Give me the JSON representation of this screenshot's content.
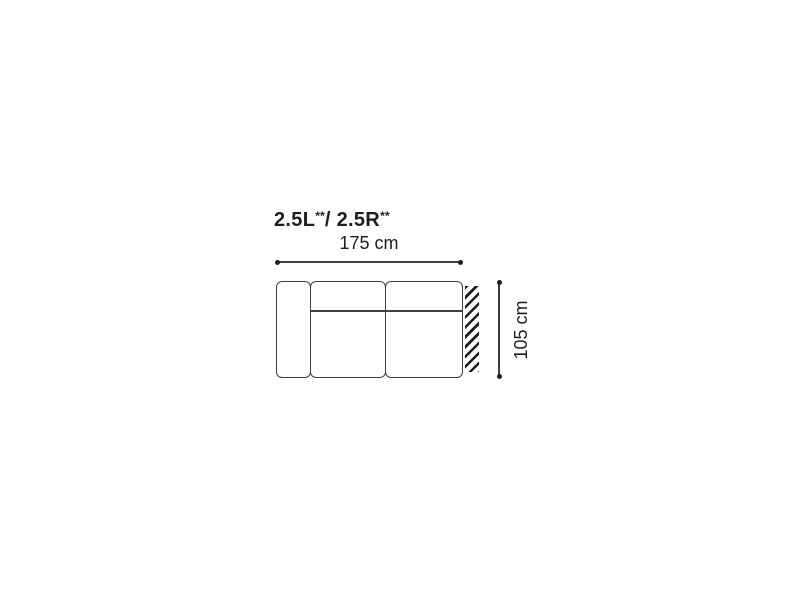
{
  "colors": {
    "bg": "#ffffff",
    "text": "#1d1d1b",
    "line": "#3f3f3f",
    "hatch": "#1d1d1b"
  },
  "figure": {
    "title": {
      "left": "2.5L",
      "left_sup": "**",
      "mid": "/ ",
      "right": "2.5R",
      "right_sup": "**"
    },
    "width_dimension_label": "175 cm",
    "depth_dimension_label": "105 cm"
  }
}
